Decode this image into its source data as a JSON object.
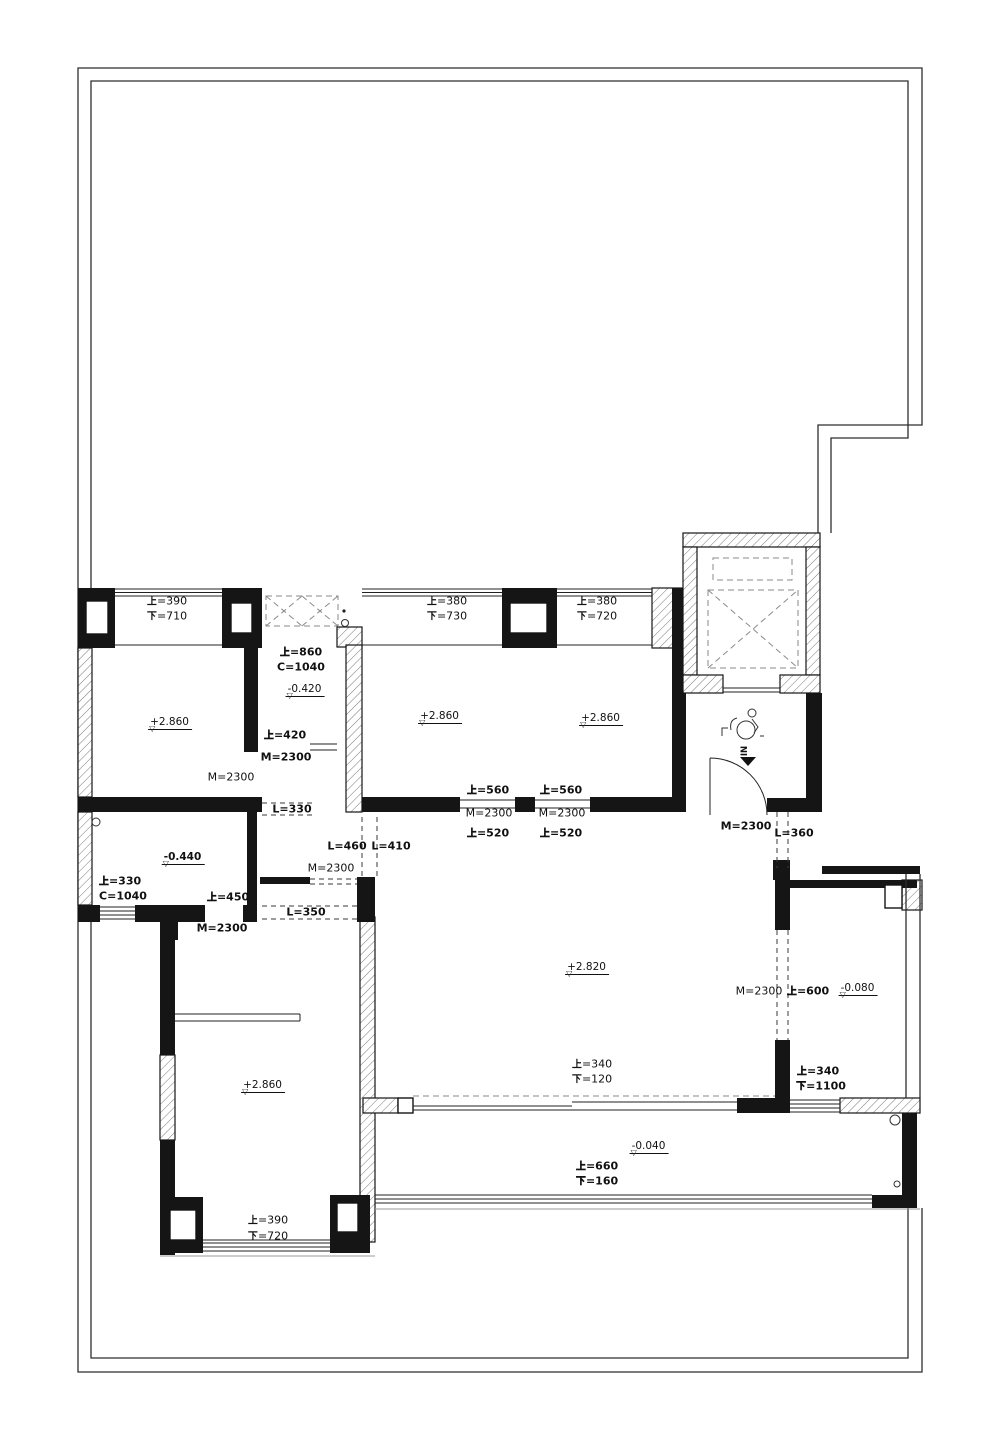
{
  "plan": {
    "entry": {
      "in_label": "IN"
    },
    "dim_labels": [
      {
        "t": "上=390",
        "x": 167,
        "y": 601
      },
      {
        "t": "下=710",
        "x": 167,
        "y": 616
      },
      {
        "t": "上=380",
        "x": 447,
        "y": 601
      },
      {
        "t": "下=730",
        "x": 447,
        "y": 616
      },
      {
        "t": "上=380",
        "x": 597,
        "y": 601
      },
      {
        "t": "下=720",
        "x": 597,
        "y": 616
      },
      {
        "t": "上=860",
        "x": 301,
        "y": 652,
        "b": 1
      },
      {
        "t": "C=1040",
        "x": 301,
        "y": 667,
        "b": 1
      },
      {
        "t": "上=420",
        "x": 285,
        "y": 735,
        "b": 1
      },
      {
        "t": "M=2300",
        "x": 286,
        "y": 757,
        "b": 1
      },
      {
        "t": "M=2300",
        "x": 231,
        "y": 777
      },
      {
        "t": "L=330",
        "x": 292,
        "y": 809,
        "b": 1
      },
      {
        "t": "L=460",
        "x": 347,
        "y": 846,
        "b": 1
      },
      {
        "t": "L=410",
        "x": 391,
        "y": 846,
        "b": 1
      },
      {
        "t": "M=2300",
        "x": 331,
        "y": 868
      },
      {
        "t": "L=350",
        "x": 306,
        "y": 912,
        "b": 1
      },
      {
        "t": "上=560",
        "x": 488,
        "y": 790,
        "b": 1
      },
      {
        "t": "M=2300",
        "x": 489,
        "y": 813
      },
      {
        "t": "上=520",
        "x": 488,
        "y": 833,
        "b": 1
      },
      {
        "t": "上=560",
        "x": 561,
        "y": 790,
        "b": 1
      },
      {
        "t": "M=2300",
        "x": 562,
        "y": 813
      },
      {
        "t": "上=520",
        "x": 561,
        "y": 833,
        "b": 1
      },
      {
        "t": "M=2300",
        "x": 746,
        "y": 826,
        "b": 1
      },
      {
        "t": "L=360",
        "x": 794,
        "y": 833,
        "b": 1
      },
      {
        "t": "上=330",
        "x": 120,
        "y": 881,
        "b": 1
      },
      {
        "t": "C=1040",
        "x": 123,
        "y": 896,
        "b": 1
      },
      {
        "t": "上=450",
        "x": 228,
        "y": 897,
        "b": 1
      },
      {
        "t": "M=2300",
        "x": 222,
        "y": 928,
        "b": 1
      },
      {
        "t": "M=2300",
        "x": 759,
        "y": 991
      },
      {
        "t": "上=600",
        "x": 808,
        "y": 991,
        "b": 1
      },
      {
        "t": "上=340",
        "x": 818,
        "y": 1071,
        "b": 1
      },
      {
        "t": "下=1100",
        "x": 821,
        "y": 1086,
        "b": 1
      },
      {
        "t": "上=340",
        "x": 592,
        "y": 1064
      },
      {
        "t": "下=120",
        "x": 592,
        "y": 1079
      },
      {
        "t": "上=660",
        "x": 597,
        "y": 1166,
        "b": 1
      },
      {
        "t": "下=160",
        "x": 597,
        "y": 1181,
        "b": 1
      },
      {
        "t": "上=390",
        "x": 268,
        "y": 1220
      },
      {
        "t": "下=720",
        "x": 268,
        "y": 1236
      }
    ],
    "level_markers": [
      {
        "t": "-0.420",
        "x": 305,
        "y": 689
      },
      {
        "t": "+2.860",
        "x": 170,
        "y": 722
      },
      {
        "t": "+2.860",
        "x": 440,
        "y": 716
      },
      {
        "t": "+2.860",
        "x": 601,
        "y": 718
      },
      {
        "t": "-0.440",
        "x": 183,
        "y": 857,
        "b": 1
      },
      {
        "t": "+2.820",
        "x": 587,
        "y": 967
      },
      {
        "t": "-0.080",
        "x": 858,
        "y": 988
      },
      {
        "t": "-0.040",
        "x": 649,
        "y": 1146
      },
      {
        "t": "+2.860",
        "x": 263,
        "y": 1085
      }
    ],
    "door_height_note": "M=2300",
    "colors": {
      "ink": "#151515",
      "hatch": "#666666",
      "light_line": "#9a9a9a"
    }
  }
}
